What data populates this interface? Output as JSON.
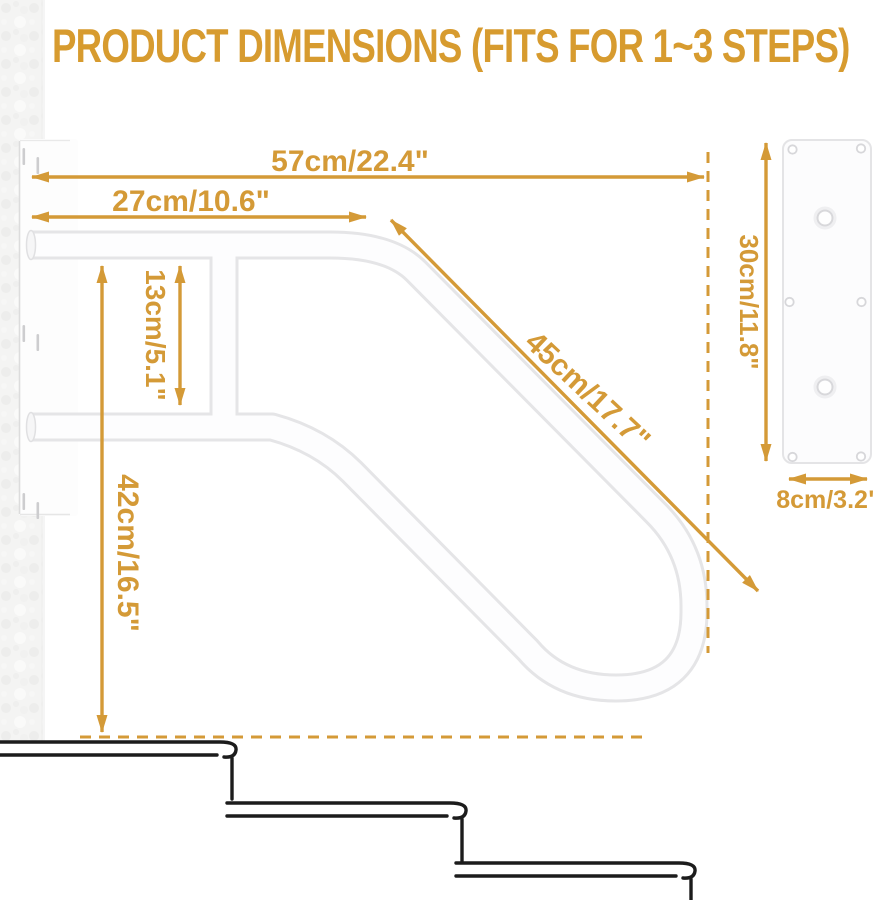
{
  "title": "PRODUCT DIMENSIONS (FITS FOR 1~3 STEPS)",
  "colors": {
    "accent": "#D49A37",
    "tube_outline": "#E5E5E7",
    "tube_fill": "#FDFDFE",
    "step_line": "#1C1C1C",
    "wall": "#F4F4F3"
  },
  "dimensions": {
    "total_width": "57cm/22.4\"",
    "upper_rail_length": "27cm/10.6\"",
    "rail_gap": "13cm/5.1\"",
    "mount_height": "42cm/16.5\"",
    "diagonal_rail": "45cm/17.7\"",
    "plate_height": "30cm/11.8\"",
    "plate_width": "8cm/3.2\""
  },
  "fits_steps": "1~3"
}
